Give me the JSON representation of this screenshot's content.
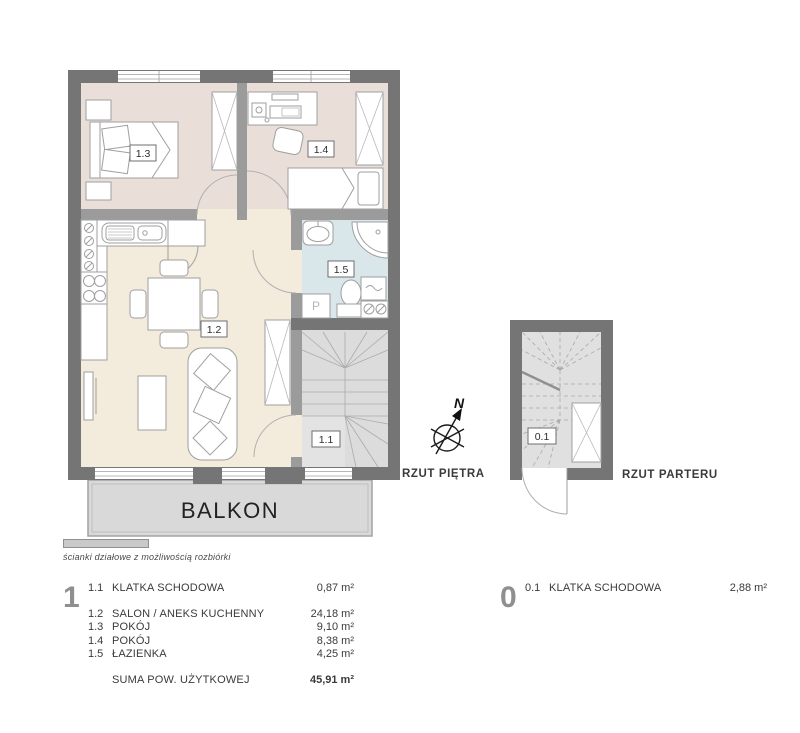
{
  "colors": {
    "structural_wall": "#757575",
    "partition_wall": "#9b9b9b",
    "bedroom_floor": "#eadfd8",
    "living_floor": "#f3ebdc",
    "bathroom_floor": "#d9e6ea",
    "stairs_floor": "#dcdcdc",
    "balcony_floor": "#d9d9d9"
  },
  "plans": {
    "upper": {
      "title": "RZUT PIĘTRA",
      "labels": {
        "r11": "1.1",
        "r12": "1.2",
        "r13": "1.3",
        "r14": "1.4",
        "r15": "1.5"
      },
      "balcony": "BALKON",
      "washer": "P"
    },
    "ground": {
      "title": "RZUT PARTERU",
      "labels": {
        "r01": "0.1"
      }
    },
    "compass": {
      "north": "N"
    }
  },
  "legend_note": {
    "text": "ścianki działowe z możliwością rozbiórki"
  },
  "tables": {
    "floor1": {
      "floor_number": "1",
      "rows": [
        {
          "code": "1.1",
          "name": "KLATKA SCHODOWA",
          "area": "0,87 m²"
        },
        {
          "code": "1.2",
          "name": "SALON / ANEKS KUCHENNY",
          "area": "24,18 m²"
        },
        {
          "code": "1.3",
          "name": "POKÓJ",
          "area": "9,10 m²"
        },
        {
          "code": "1.4",
          "name": "POKÓJ",
          "area": "8,38 m²"
        },
        {
          "code": "1.5",
          "name": "ŁAZIENKA",
          "area": "4,25 m²"
        }
      ],
      "total_label": "SUMA POW. UŻYTKOWEJ",
      "total_area": "45,91 m²"
    },
    "floor0": {
      "floor_number": "0",
      "rows": [
        {
          "code": "0.1",
          "name": "KLATKA SCHODOWA",
          "area": "2,88 m²"
        }
      ]
    }
  }
}
